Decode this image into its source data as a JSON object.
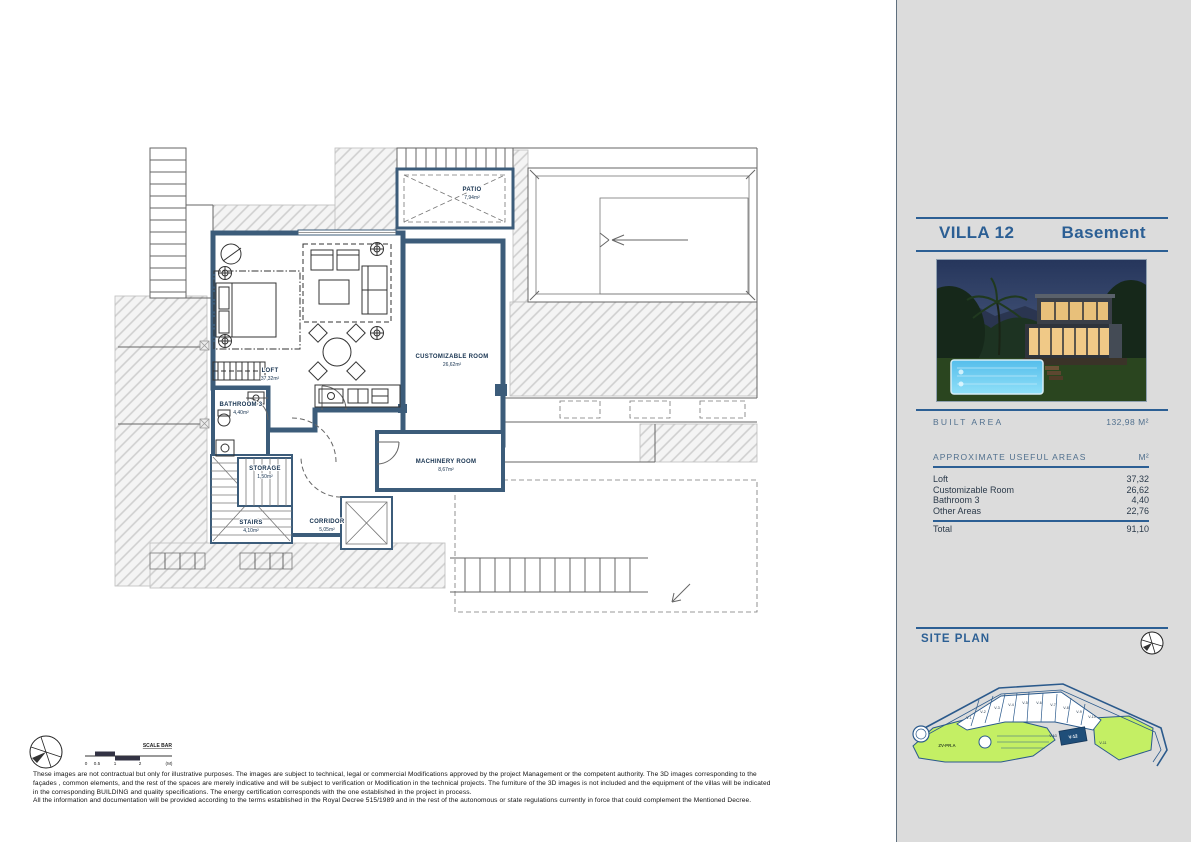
{
  "sidebar": {
    "title": "VILLA 12",
    "subtitle": "Basement",
    "built_area": {
      "label": "BUILT AREA",
      "value": "132,98 M²"
    },
    "useful_areas": {
      "heading": "APPROXIMATE USEFUL AREAS",
      "unit": "M²",
      "rows": [
        {
          "label": "Loft",
          "value": "37,32"
        },
        {
          "label": "Customizable Room",
          "value": "26,62"
        },
        {
          "label": "Bathroom 3",
          "value": "4,40"
        },
        {
          "label": "Other Areas",
          "value": "22,76"
        }
      ],
      "total_label": "Total",
      "total_value": "91,10"
    },
    "site_plan": {
      "heading": "SITE PLAN",
      "zone_label": "ZV-PR.A",
      "plots": [
        "V-1",
        "V-2",
        "V-3",
        "V-4",
        "V-5",
        "V-6",
        "V-7",
        "V-8",
        "V-9",
        "V-10",
        "V-13",
        "V-12",
        "V-11"
      ],
      "highlighted_plot": "V-12"
    }
  },
  "floor_plan": {
    "rooms": [
      {
        "name": "PATIO",
        "area": "7,94m²"
      },
      {
        "name": "LOFT",
        "area": "37,32m²"
      },
      {
        "name": "CUSTOMIZABLE ROOM",
        "area": "26,62m²"
      },
      {
        "name": "BATHROOM 3",
        "area": "4,40m²"
      },
      {
        "name": "STORAGE",
        "area": "1,50m²"
      },
      {
        "name": "STAIRS",
        "area": "4,10m²"
      },
      {
        "name": "CORRIDOR",
        "area": "5,05m²"
      },
      {
        "name": "MACHINERY ROOM",
        "area": "8,67m²"
      }
    ],
    "scale_bar": {
      "label": "SCALE BAR",
      "ticks": [
        "0",
        "0.5",
        "1",
        "2"
      ],
      "unit": "(M)"
    }
  },
  "footer": {
    "disclaimer_lines": [
      "These images are not contractual but only for illustrative purposes. The images are subject to technical, legal or commercial Modifications approved by the project Management or the competent authority. The 3D images corresponding to the",
      "façades , common elements, and the rest of the spaces are merely indicative and will be subject to verification or Modification in the technical projects. The furniture of the 3D images is not included and the equipment of the villas will be indicated",
      "in the corresponding BUILDING and quality specifications. The energy certification corresponds with the one established in the project in process.",
      "All the information and documentation will be provided according to the terms established in the Royal Decree 515/1989 and in the rest of the autonomous or state regulations currently in force that could complement the Mentioned Decree."
    ]
  },
  "colors": {
    "accent_blue": "#2c5f94",
    "wall_blue": "#3c5c7a",
    "sidebar_gray": "#dcdcdc",
    "siteplan_green": "#c4ef64",
    "highlight_plot": "#1f4e79"
  }
}
